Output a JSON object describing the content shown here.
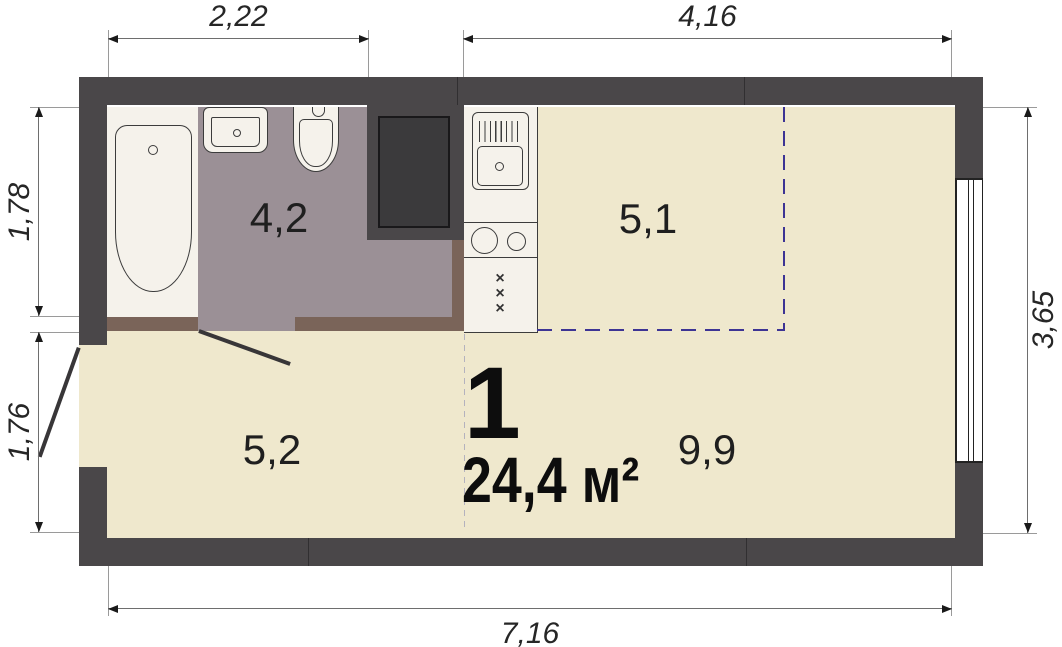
{
  "plan": {
    "unit_label": "1",
    "area_label": "24,4 м²",
    "rooms": [
      {
        "name": "bathroom",
        "area": "4,2"
      },
      {
        "name": "kitchen",
        "area": "5,1"
      },
      {
        "name": "hallway",
        "area": "5,2"
      },
      {
        "name": "living-room",
        "area": "9,9"
      }
    ],
    "dimensions": {
      "top_left": "2,22",
      "top_right": "4,16",
      "left_upper": "1,78",
      "left_lower": "1,76",
      "right": "3,65",
      "bottom": "7,16"
    },
    "appliance_mark": "×",
    "fixtures": [
      "bathtub",
      "washbasin",
      "toilet",
      "kitchen-sink",
      "stove",
      "appliance-unit",
      "window",
      "entry-door",
      "bathroom-door",
      "shaft"
    ],
    "colors": {
      "wall": "#4a4749",
      "floor_main": "#efe8cd",
      "floor_bathroom": "#9b9096",
      "fixture_zone": "#f5f2eb",
      "partition": "#7a6459",
      "kitchen_zone_dash": "#3d3494",
      "zone_divider_dash": "#b4b2be",
      "dimension_line": "#6e6e6e"
    }
  }
}
